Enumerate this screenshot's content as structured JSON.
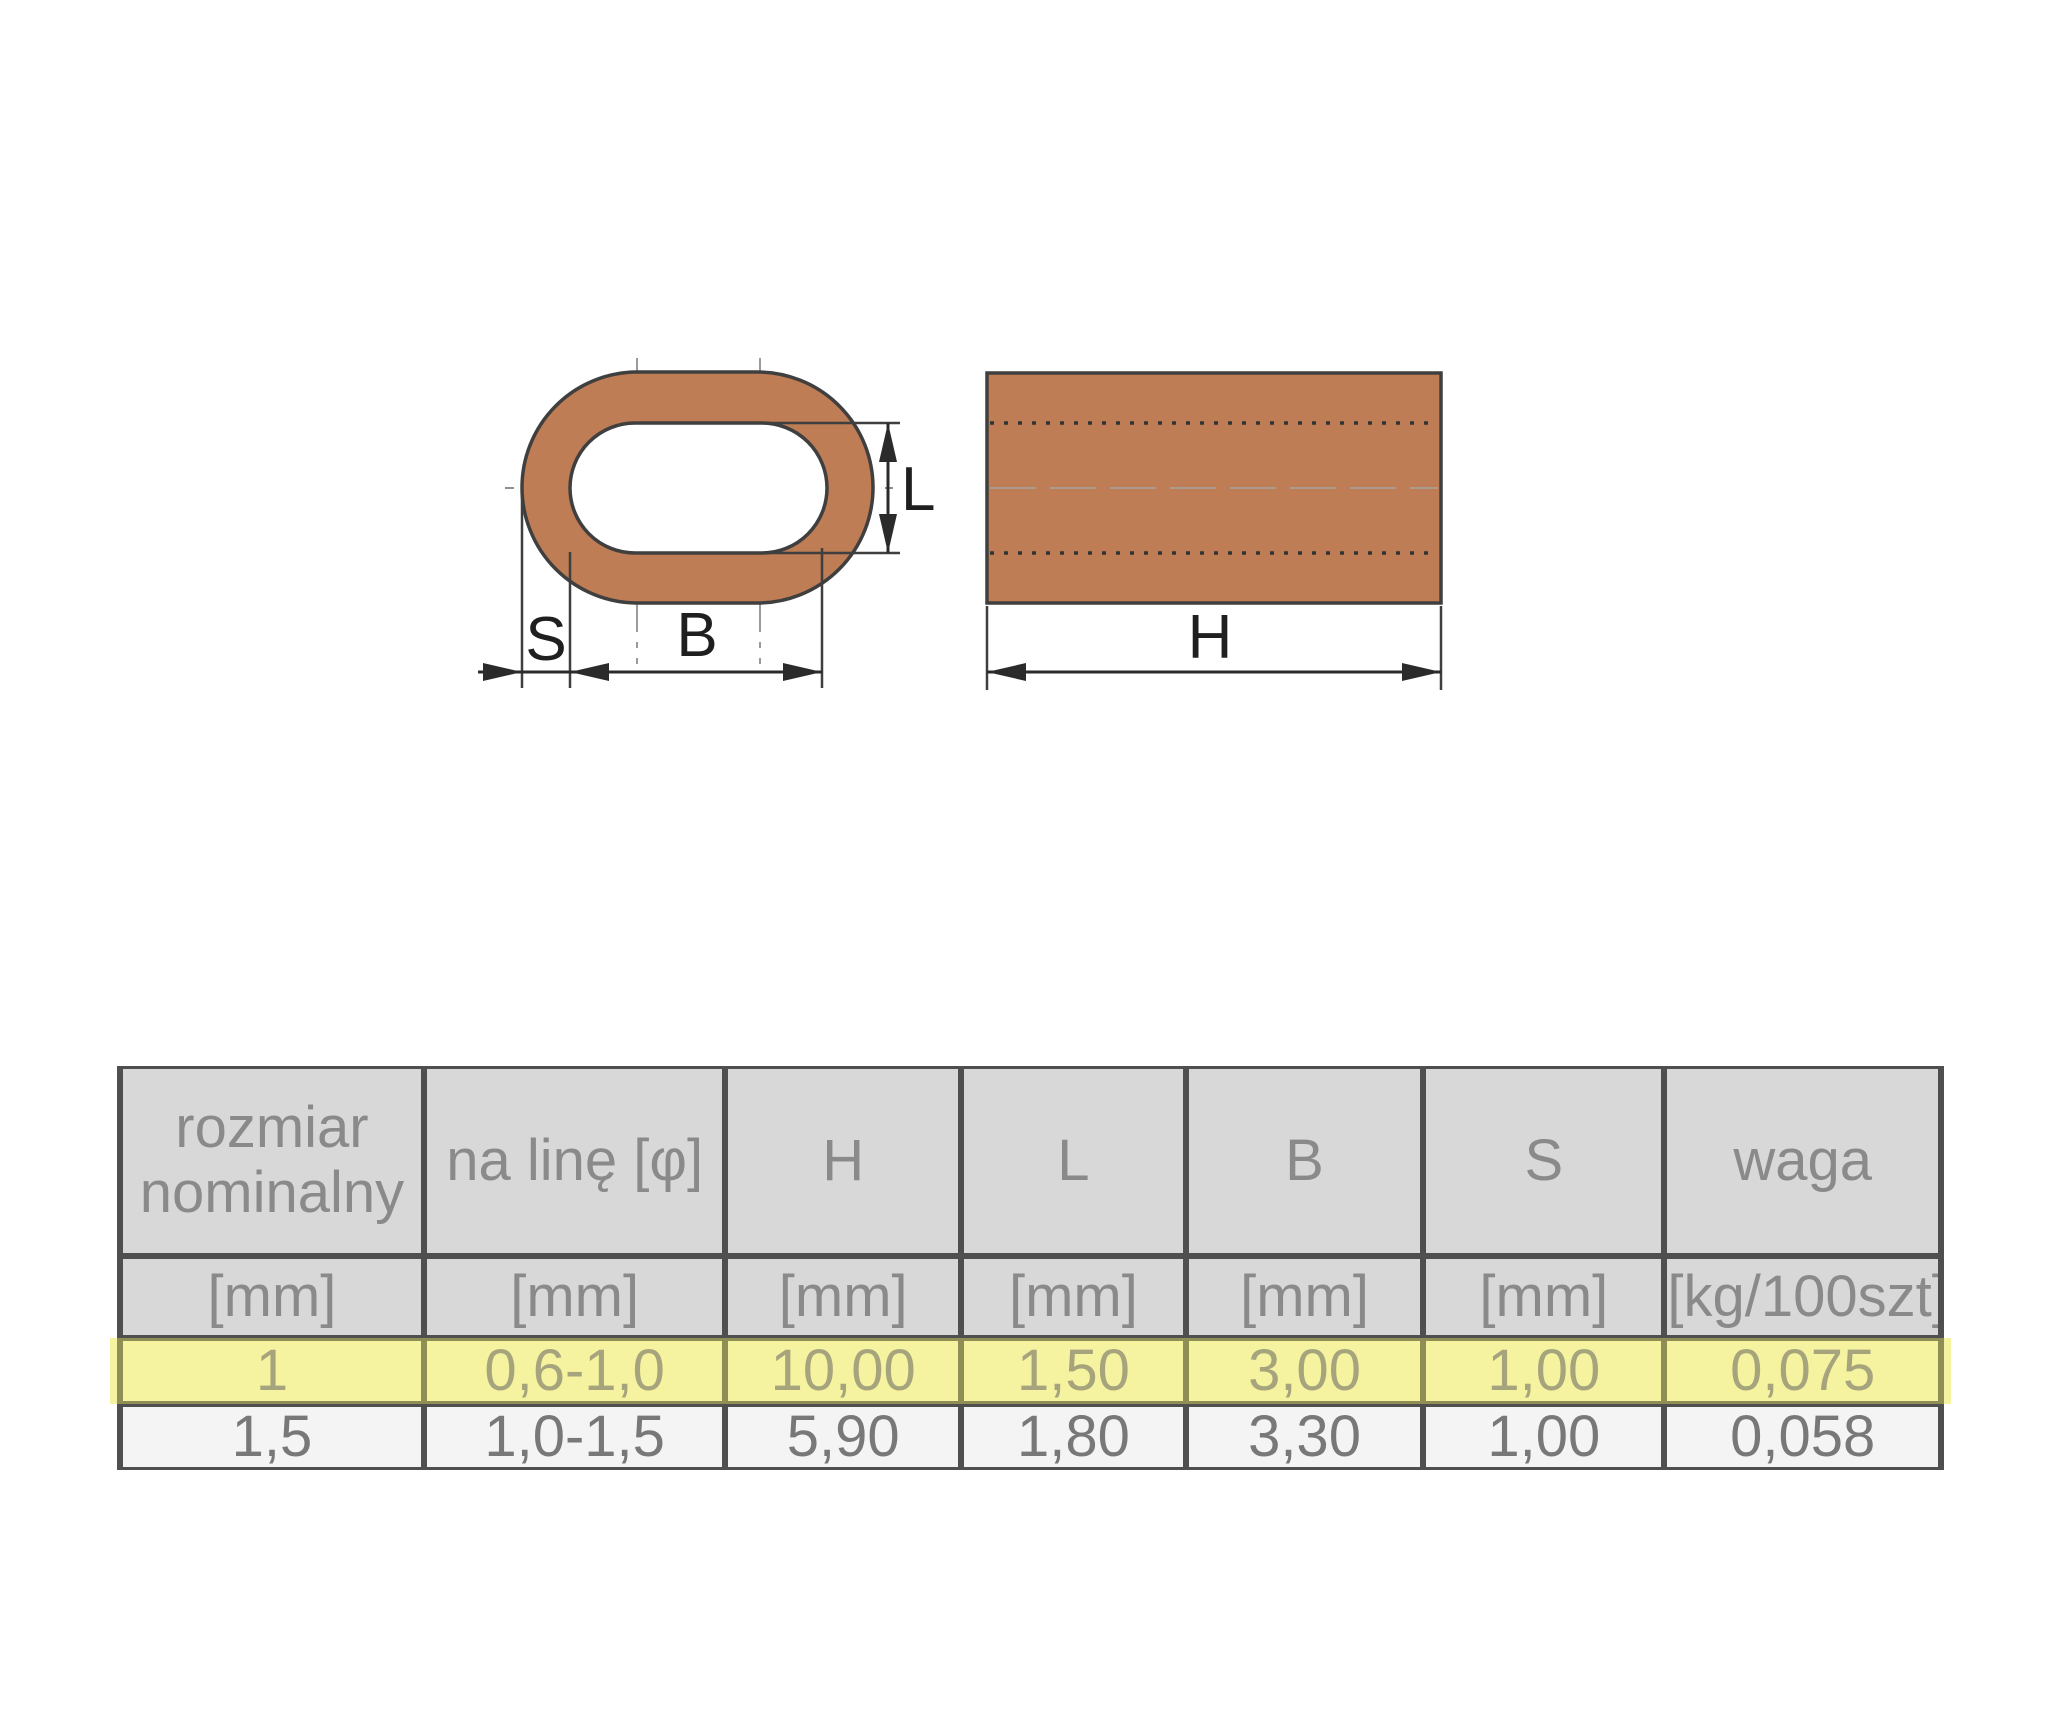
{
  "diagram": {
    "dim_labels": {
      "S": "S",
      "B": "B",
      "L": "L",
      "H": "H"
    },
    "fill_color": "#bf7d55",
    "outline_color": "#3f3f3f",
    "dimension_color": "#2b2b2b",
    "views": [
      "cross-section",
      "side-view"
    ]
  },
  "table": {
    "header": [
      "rozmiar nominalny",
      "na linę [φ]",
      "H",
      "L",
      "B",
      "S",
      "waga"
    ],
    "units": [
      "[mm]",
      "[mm]",
      "[mm]",
      "[mm]",
      "[mm]",
      "[mm]",
      "[kg/100szt]"
    ],
    "rows": [
      {
        "highlighted": true,
        "cells": [
          "1",
          "0,6-1,0",
          "10,00",
          "1,50",
          "3,00",
          "1,00",
          "0,075"
        ]
      },
      {
        "highlighted": false,
        "cells": [
          "1,5",
          "1,0-1,5",
          "5,90",
          "1,80",
          "3,30",
          "1,00",
          "0,058"
        ]
      }
    ],
    "colors": {
      "header_bg": "#d8d8d8",
      "header_text": "#8a8a8a",
      "border": "#4f4f4f",
      "highlight_bg": "#f5f2a0",
      "highlight_text": "#a6a47c",
      "highlight_border": "#8e8e55",
      "row_bg": "#f4f4f4",
      "row_text": "#787878"
    }
  }
}
